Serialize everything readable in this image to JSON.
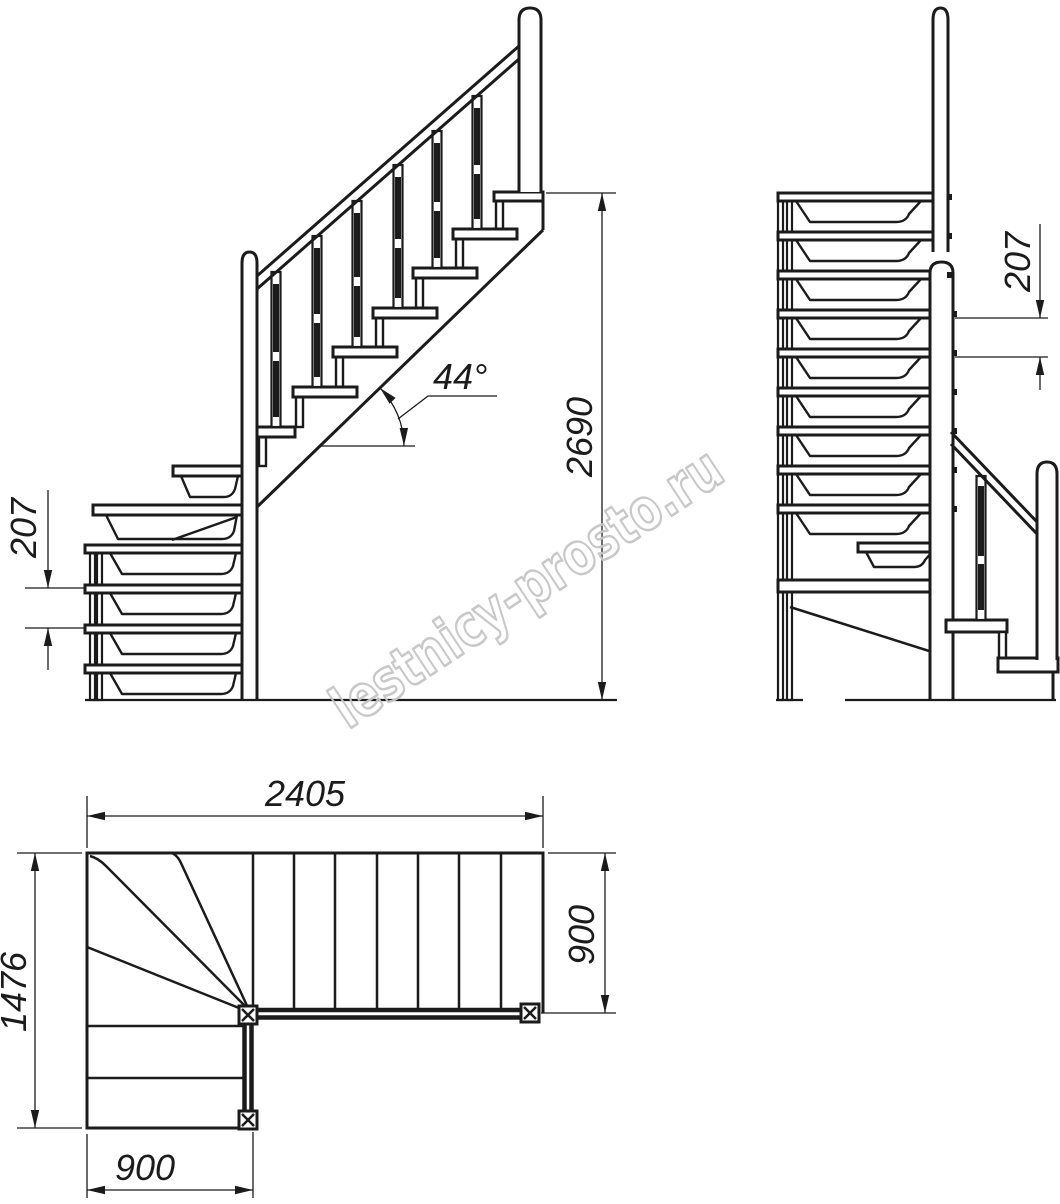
{
  "palette": {
    "ink": "#1b1b1b",
    "watermark": "#c6c6c6",
    "background": "#ffffff"
  },
  "watermark": {
    "text": "lestnicy-prosto.ru"
  },
  "views": {
    "elevation": {
      "slope_angle": "44°",
      "total_height": "2690",
      "riser_height": "207"
    },
    "side": {
      "riser_height": "207"
    },
    "plan": {
      "total_length": "2405",
      "flight_width": "900",
      "total_width": "1476",
      "lower_flight_width": "900"
    }
  }
}
